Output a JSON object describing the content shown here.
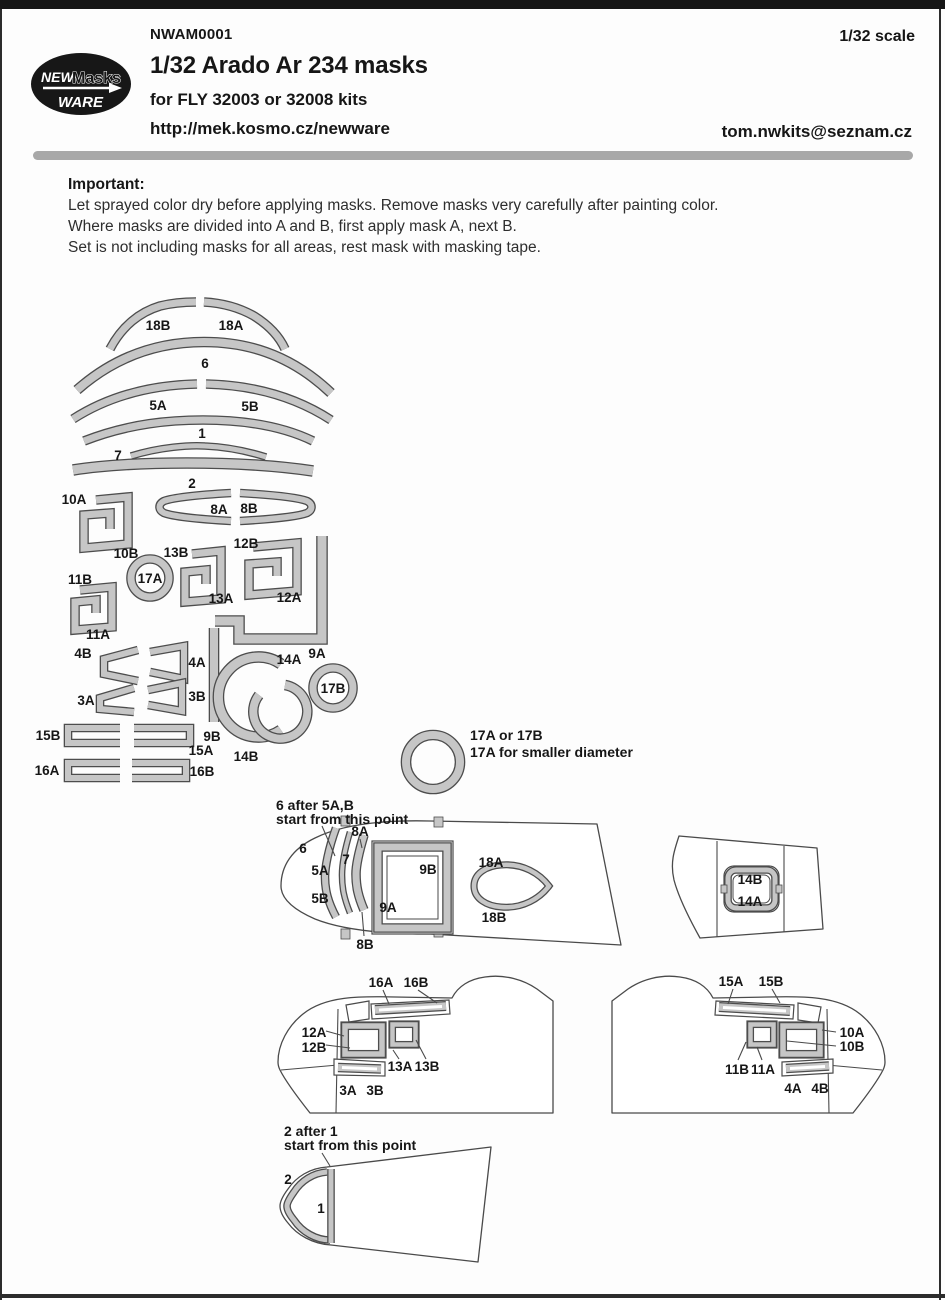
{
  "colors": {
    "mask_fill": "#c6c6c6",
    "mask_outline": "#4d4d4d",
    "line_color": "#4a4a4a",
    "divider": "#a8a8a8",
    "header_band": "#161616"
  },
  "header": {
    "code": "NWAM0001",
    "title": "1/32 Arado Ar 234 masks",
    "subtitle": "for FLY 32003 or 32008 kits",
    "url": "http://mek.kosmo.cz/newware",
    "scale": "1/32 scale",
    "email": "tom.nwkits@seznam.cz",
    "logo": {
      "new": "NEW",
      "masks": "Masks",
      "ware": "WARE"
    }
  },
  "notes": {
    "heading": "Important:",
    "line1": "Let sprayed color dry before applying masks. Remove masks very carefully after painting color.",
    "line2": "Where masks are divided into A and B, first apply mask A, next B.",
    "line3": "Set is not including masks for all areas, rest mask with masking tape."
  },
  "annotations": {
    "ring_note_1": "17A or 17B",
    "ring_note_2": "17A for smaller diameter",
    "canopy_note_1": "6 after 5A,B",
    "canopy_note_2": "start from this point",
    "bottom_note_1": "2 after 1",
    "bottom_note_2": "start from this point"
  },
  "labels": {
    "m1": "1",
    "m2": "2",
    "m3A": "3A",
    "m3B": "3B",
    "m4A": "4A",
    "m4B": "4B",
    "m5A": "5A",
    "m5B": "5B",
    "m6": "6",
    "m7": "7",
    "m8A": "8A",
    "m8B": "8B",
    "m9A": "9A",
    "m9B": "9B",
    "m10A": "10A",
    "m10B": "10B",
    "m11A": "11A",
    "m11B": "11B",
    "m12A": "12A",
    "m12B": "12B",
    "m13A": "13A",
    "m13B": "13B",
    "m14A": "14A",
    "m14B": "14B",
    "m15A": "15A",
    "m15B": "15B",
    "m16A": "16A",
    "m16B": "16B",
    "m17A": "17A",
    "m17B": "17B",
    "m18A": "18A",
    "m18B": "18B"
  }
}
